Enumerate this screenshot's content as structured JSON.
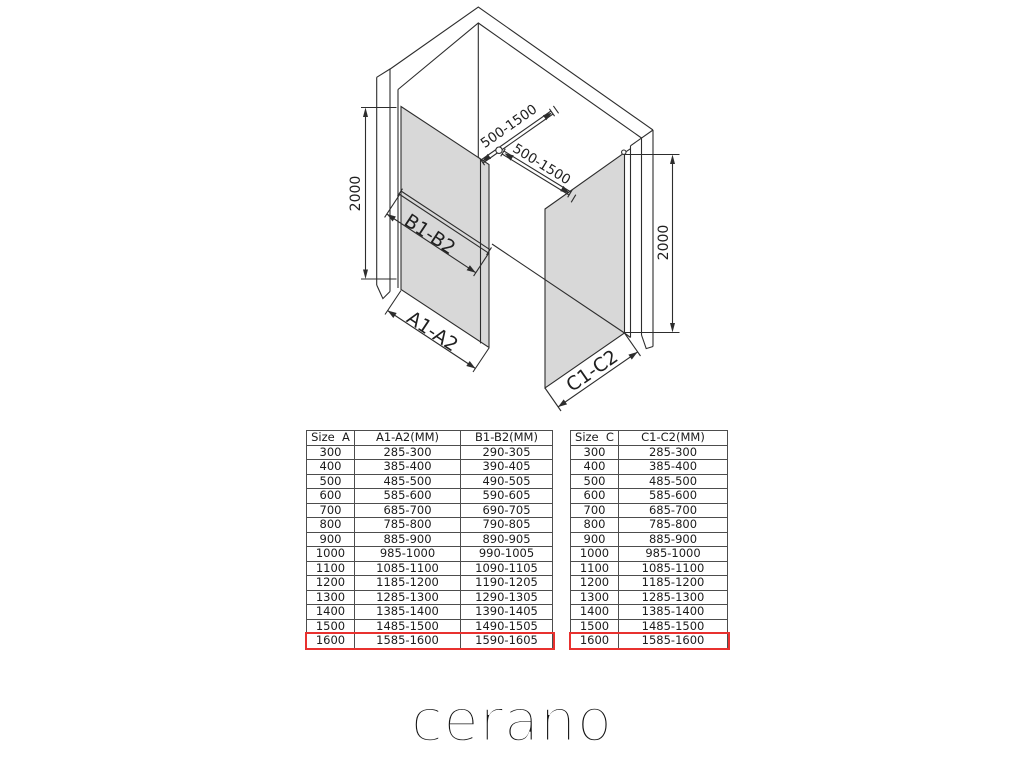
{
  "brand": {
    "logo_text": "cerano"
  },
  "diagram": {
    "labels": {
      "left_height": "2000",
      "right_height": "2000",
      "top_bar_left": "500-1500",
      "top_bar_right": "500-1500",
      "mid_bar": "B1-B2",
      "left_panel_width": "A1-A2",
      "right_panel_width": "C1-C2"
    },
    "colors": {
      "glass": "#d8d8d8",
      "line": "#2d2d2d",
      "highlight": "#e8312f"
    }
  },
  "tables": {
    "left": {
      "headers": [
        "Size  A",
        "A1-A2(MM)",
        "B1-B2(MM)"
      ],
      "rows": [
        [
          "300",
          "285-300",
          "290-305"
        ],
        [
          "400",
          "385-400",
          "390-405"
        ],
        [
          "500",
          "485-500",
          "490-505"
        ],
        [
          "600",
          "585-600",
          "590-605"
        ],
        [
          "700",
          "685-700",
          "690-705"
        ],
        [
          "800",
          "785-800",
          "790-805"
        ],
        [
          "900",
          "885-900",
          "890-905"
        ],
        [
          "1000",
          "985-1000",
          "990-1005"
        ],
        [
          "1100",
          "1085-1100",
          "1090-1105"
        ],
        [
          "1200",
          "1185-1200",
          "1190-1205"
        ],
        [
          "1300",
          "1285-1300",
          "1290-1305"
        ],
        [
          "1400",
          "1385-1400",
          "1390-1405"
        ],
        [
          "1500",
          "1485-1500",
          "1490-1505"
        ],
        [
          "1600",
          "1585-1600",
          "1590-1605"
        ]
      ],
      "highlight_row_index": 13
    },
    "right": {
      "headers": [
        "Size  C",
        "C1-C2(MM)"
      ],
      "rows": [
        [
          "300",
          "285-300"
        ],
        [
          "400",
          "385-400"
        ],
        [
          "500",
          "485-500"
        ],
        [
          "600",
          "585-600"
        ],
        [
          "700",
          "685-700"
        ],
        [
          "800",
          "785-800"
        ],
        [
          "900",
          "885-900"
        ],
        [
          "1000",
          "985-1000"
        ],
        [
          "1100",
          "1085-1100"
        ],
        [
          "1200",
          "1185-1200"
        ],
        [
          "1300",
          "1285-1300"
        ],
        [
          "1400",
          "1385-1400"
        ],
        [
          "1500",
          "1485-1500"
        ],
        [
          "1600",
          "1585-1600"
        ]
      ],
      "highlight_row_index": 13
    }
  }
}
